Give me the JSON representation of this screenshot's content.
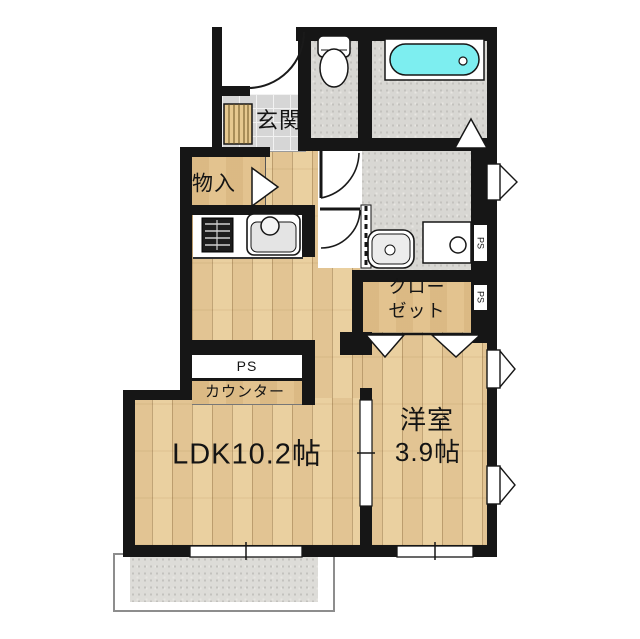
{
  "plan": {
    "rooms": {
      "entrance": {
        "label": "玄関"
      },
      "storage": {
        "label": "物入"
      },
      "ldk": {
        "label": "LDK10.2帖"
      },
      "western_room": {
        "label_line1": "洋室",
        "label_line2": "3.9帖"
      },
      "closet": {
        "label_line1": "クロー",
        "label_line2": "ゼット"
      },
      "counter": {
        "label": "カウンター"
      },
      "pipe_space_counter": {
        "label": "PS"
      },
      "pipe_space_shaft_upper": {
        "label": "PS"
      },
      "pipe_space_shaft_lower": {
        "label": "PS"
      }
    },
    "fixtures": [
      "bathtub",
      "toilet",
      "washbasin",
      "washing-machine-pan",
      "gas-stove",
      "kitchen-sink",
      "shoe-cabinet",
      "entrance-door-arc",
      "toilet-door-arc",
      "washroom-door-arc",
      "storage-door",
      "bathroom-folding-door",
      "closet-bifold-doors",
      "sliding-door",
      "casement-windows",
      "sliding-windows",
      "balcony"
    ],
    "colors": {
      "wall": "#161616",
      "wood_floor": "#ecd2a2",
      "tan_floor": "#e3c38f",
      "tile_floor": "#d6d6d6",
      "wet_area_floor": "#d8d7d3",
      "bathtub_water": "#7deef0",
      "background": "#ffffff"
    }
  }
}
